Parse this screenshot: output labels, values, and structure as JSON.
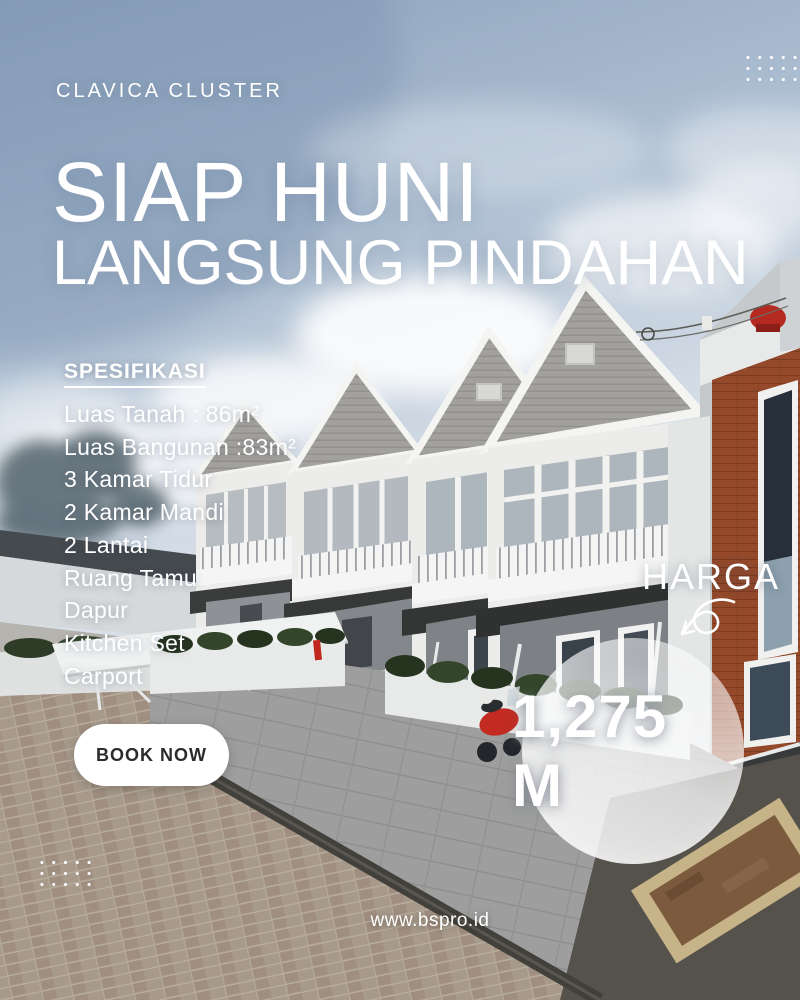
{
  "poster": {
    "brand": "CLAVICA CLUSTER",
    "headline": {
      "line1": "SIAP HUNI",
      "line2": "LANGSUNG PINDAHAN"
    },
    "specs": {
      "title": "SPESIFIKASI",
      "items": [
        "Luas Tanah : 86m²",
        "Luas Bangunan :83m²",
        "3 Kamar Tidur",
        "2 Kamar Mandi",
        "2 Lantai",
        "Ruang Tamu",
        "Dapur",
        "Kitchen Set",
        "Carport"
      ]
    },
    "cta_label": "BOOK NOW",
    "price": {
      "label": "HARGA",
      "value": "1,275 M"
    },
    "website": "www.bspro.id",
    "colors": {
      "text": "#ffffff",
      "cta_bg": "#ffffff",
      "cta_text": "#2b2b2b",
      "price_circle": "rgba(255,255,255,0.72)",
      "sky_top": "#8aa0bb",
      "brick_accent": "#94492a",
      "canopy_dark": "#333634"
    }
  }
}
